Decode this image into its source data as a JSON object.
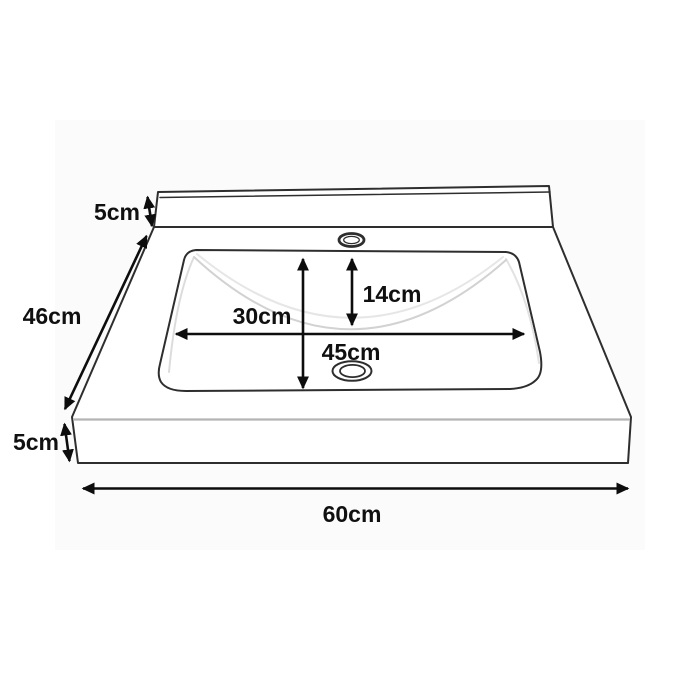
{
  "diagram": {
    "subject": "washbasin-dimension-diagram",
    "dimensions": {
      "top_back_panel": "5cm",
      "left_side": "46cm",
      "bottom_left_edge": "5cm",
      "bottom_width": "60cm",
      "basin_vertical": "30cm",
      "basin_inner": "14cm",
      "basin_horizontal": "45cm"
    },
    "colors": {
      "background": "#ffffff",
      "canvas_panel": "#fbfbfb",
      "outline": "#2e2e2e",
      "dimension_line": "#0d0d0d",
      "label_text": "#101010",
      "soft_front_edge": "#b4b4b4",
      "bowl_shading": "#d9d9d9"
    }
  }
}
